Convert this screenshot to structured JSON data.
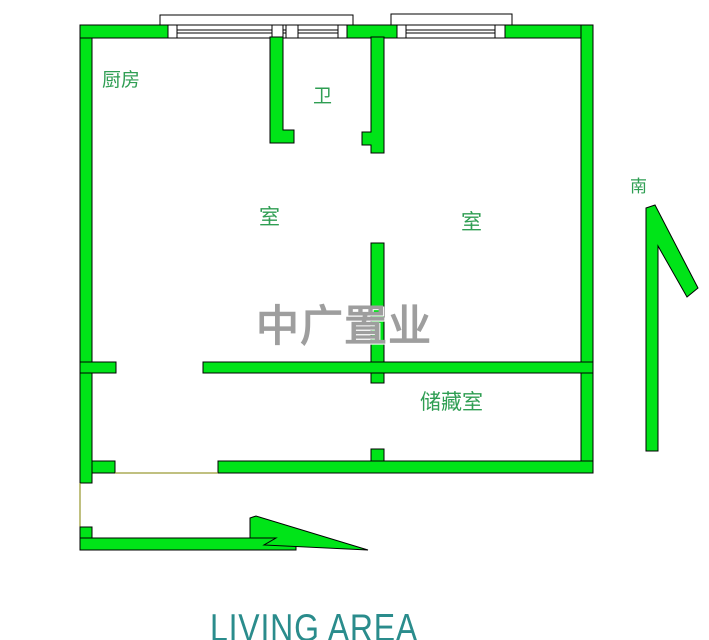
{
  "colors": {
    "wall_green": "#00E418",
    "label_green": "#2F9E53",
    "watermark_gray": "#9E9E9E",
    "footer_teal": "#2A8C8C",
    "threshold_olive": "#808000"
  },
  "floorplan": {
    "labels": {
      "kitchen": "厨房",
      "bathroom": "卫",
      "room_left": "室",
      "room_right": "室",
      "storage": "储藏室",
      "south": "南"
    },
    "icons": {
      "south_arrow": "arrow-pointing-up-south-indicator",
      "entry_arrow": "arrow-pointing-right-entry-indicator"
    },
    "watermark": "中广置业",
    "footer": "LIVING AREA"
  }
}
